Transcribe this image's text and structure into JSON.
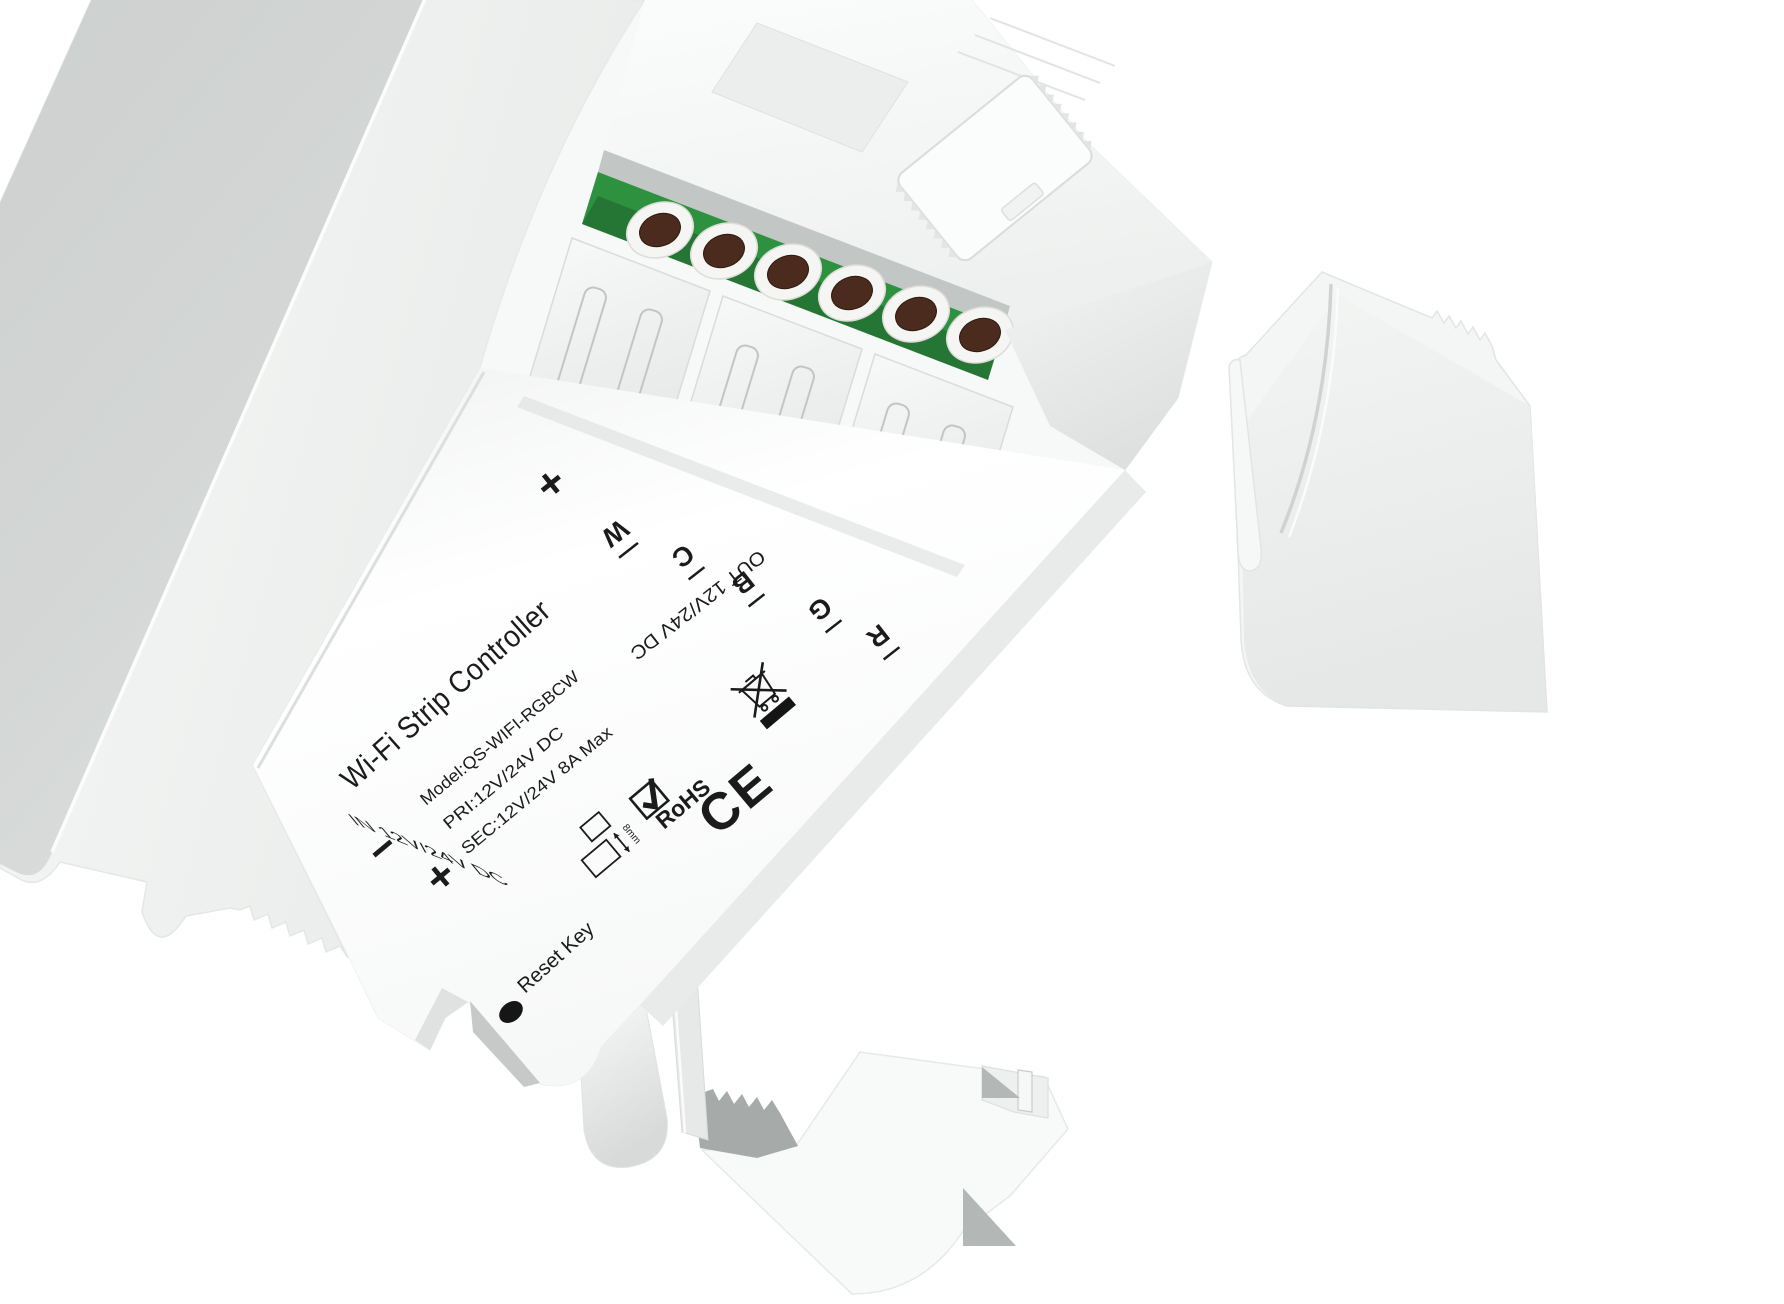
{
  "product": {
    "title": "Wi-Fi Strip Controller",
    "model": "Model:QS-WIFI-RGBCW",
    "primary": "PRI:12V/24V DC",
    "secondary": "SEC:12V/24V 8A Max",
    "input": "IN 12V/24V DC",
    "output": "OUT 12V/24V DC",
    "reset": "Reset Key",
    "plus_out": "+",
    "minus_in": "−",
    "plus_in": "+",
    "terminal_labels": [
      "W",
      "C",
      "B",
      "G",
      "R"
    ],
    "marks": {
      "rohs": "RoHS",
      "ce": "CE",
      "strip_width": "8mm"
    }
  },
  "colors": {
    "pcb_green": "#2E9140",
    "pcb_green_dark": "#1D7230",
    "screw_brown": "#4A2B1D",
    "print_black": "#1B1B1B",
    "plastic_white": "#F7F8F8",
    "back_plate_gray": "#D0D3D2"
  }
}
